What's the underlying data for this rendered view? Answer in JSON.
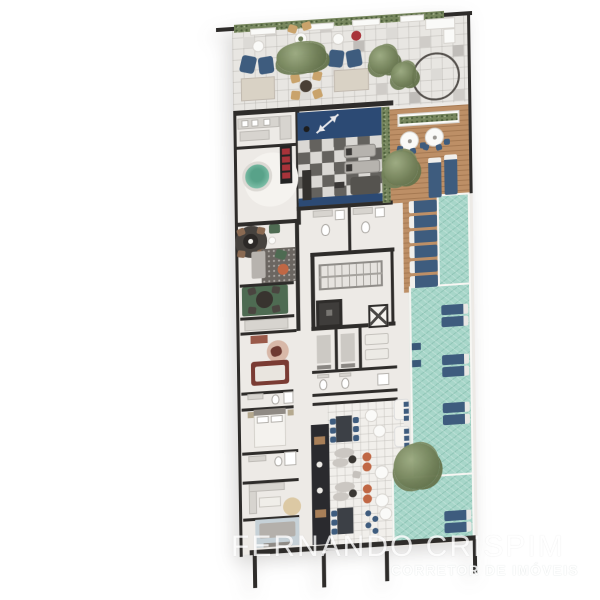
{
  "watermark": {
    "title": "FERNANDO CRISPIM",
    "subtitle": "CORRETOR DE IMÓVEIS"
  },
  "colors": {
    "canvas": "#ffffff",
    "wall": "#2e2c2a",
    "floor_light": "#edeae6",
    "terrace_tile": "#e8e6e2",
    "pool_water": "#a7d6c9",
    "deck_wood": "#bd8f66",
    "gym_blue": "#2c4a74",
    "lounger_blue": "#3e5c7e",
    "plant_green": "#6d7c53",
    "spa_green": "#7fc0a9",
    "rug_green": "#4e6b52",
    "sofa_red": "#7a3b33",
    "pouf_orange": "#c06744",
    "chair_tan": "#c9a36b",
    "table_beige": "#d9d2c5",
    "accent_red": "#a8333a",
    "watermark": "#ffffff"
  }
}
